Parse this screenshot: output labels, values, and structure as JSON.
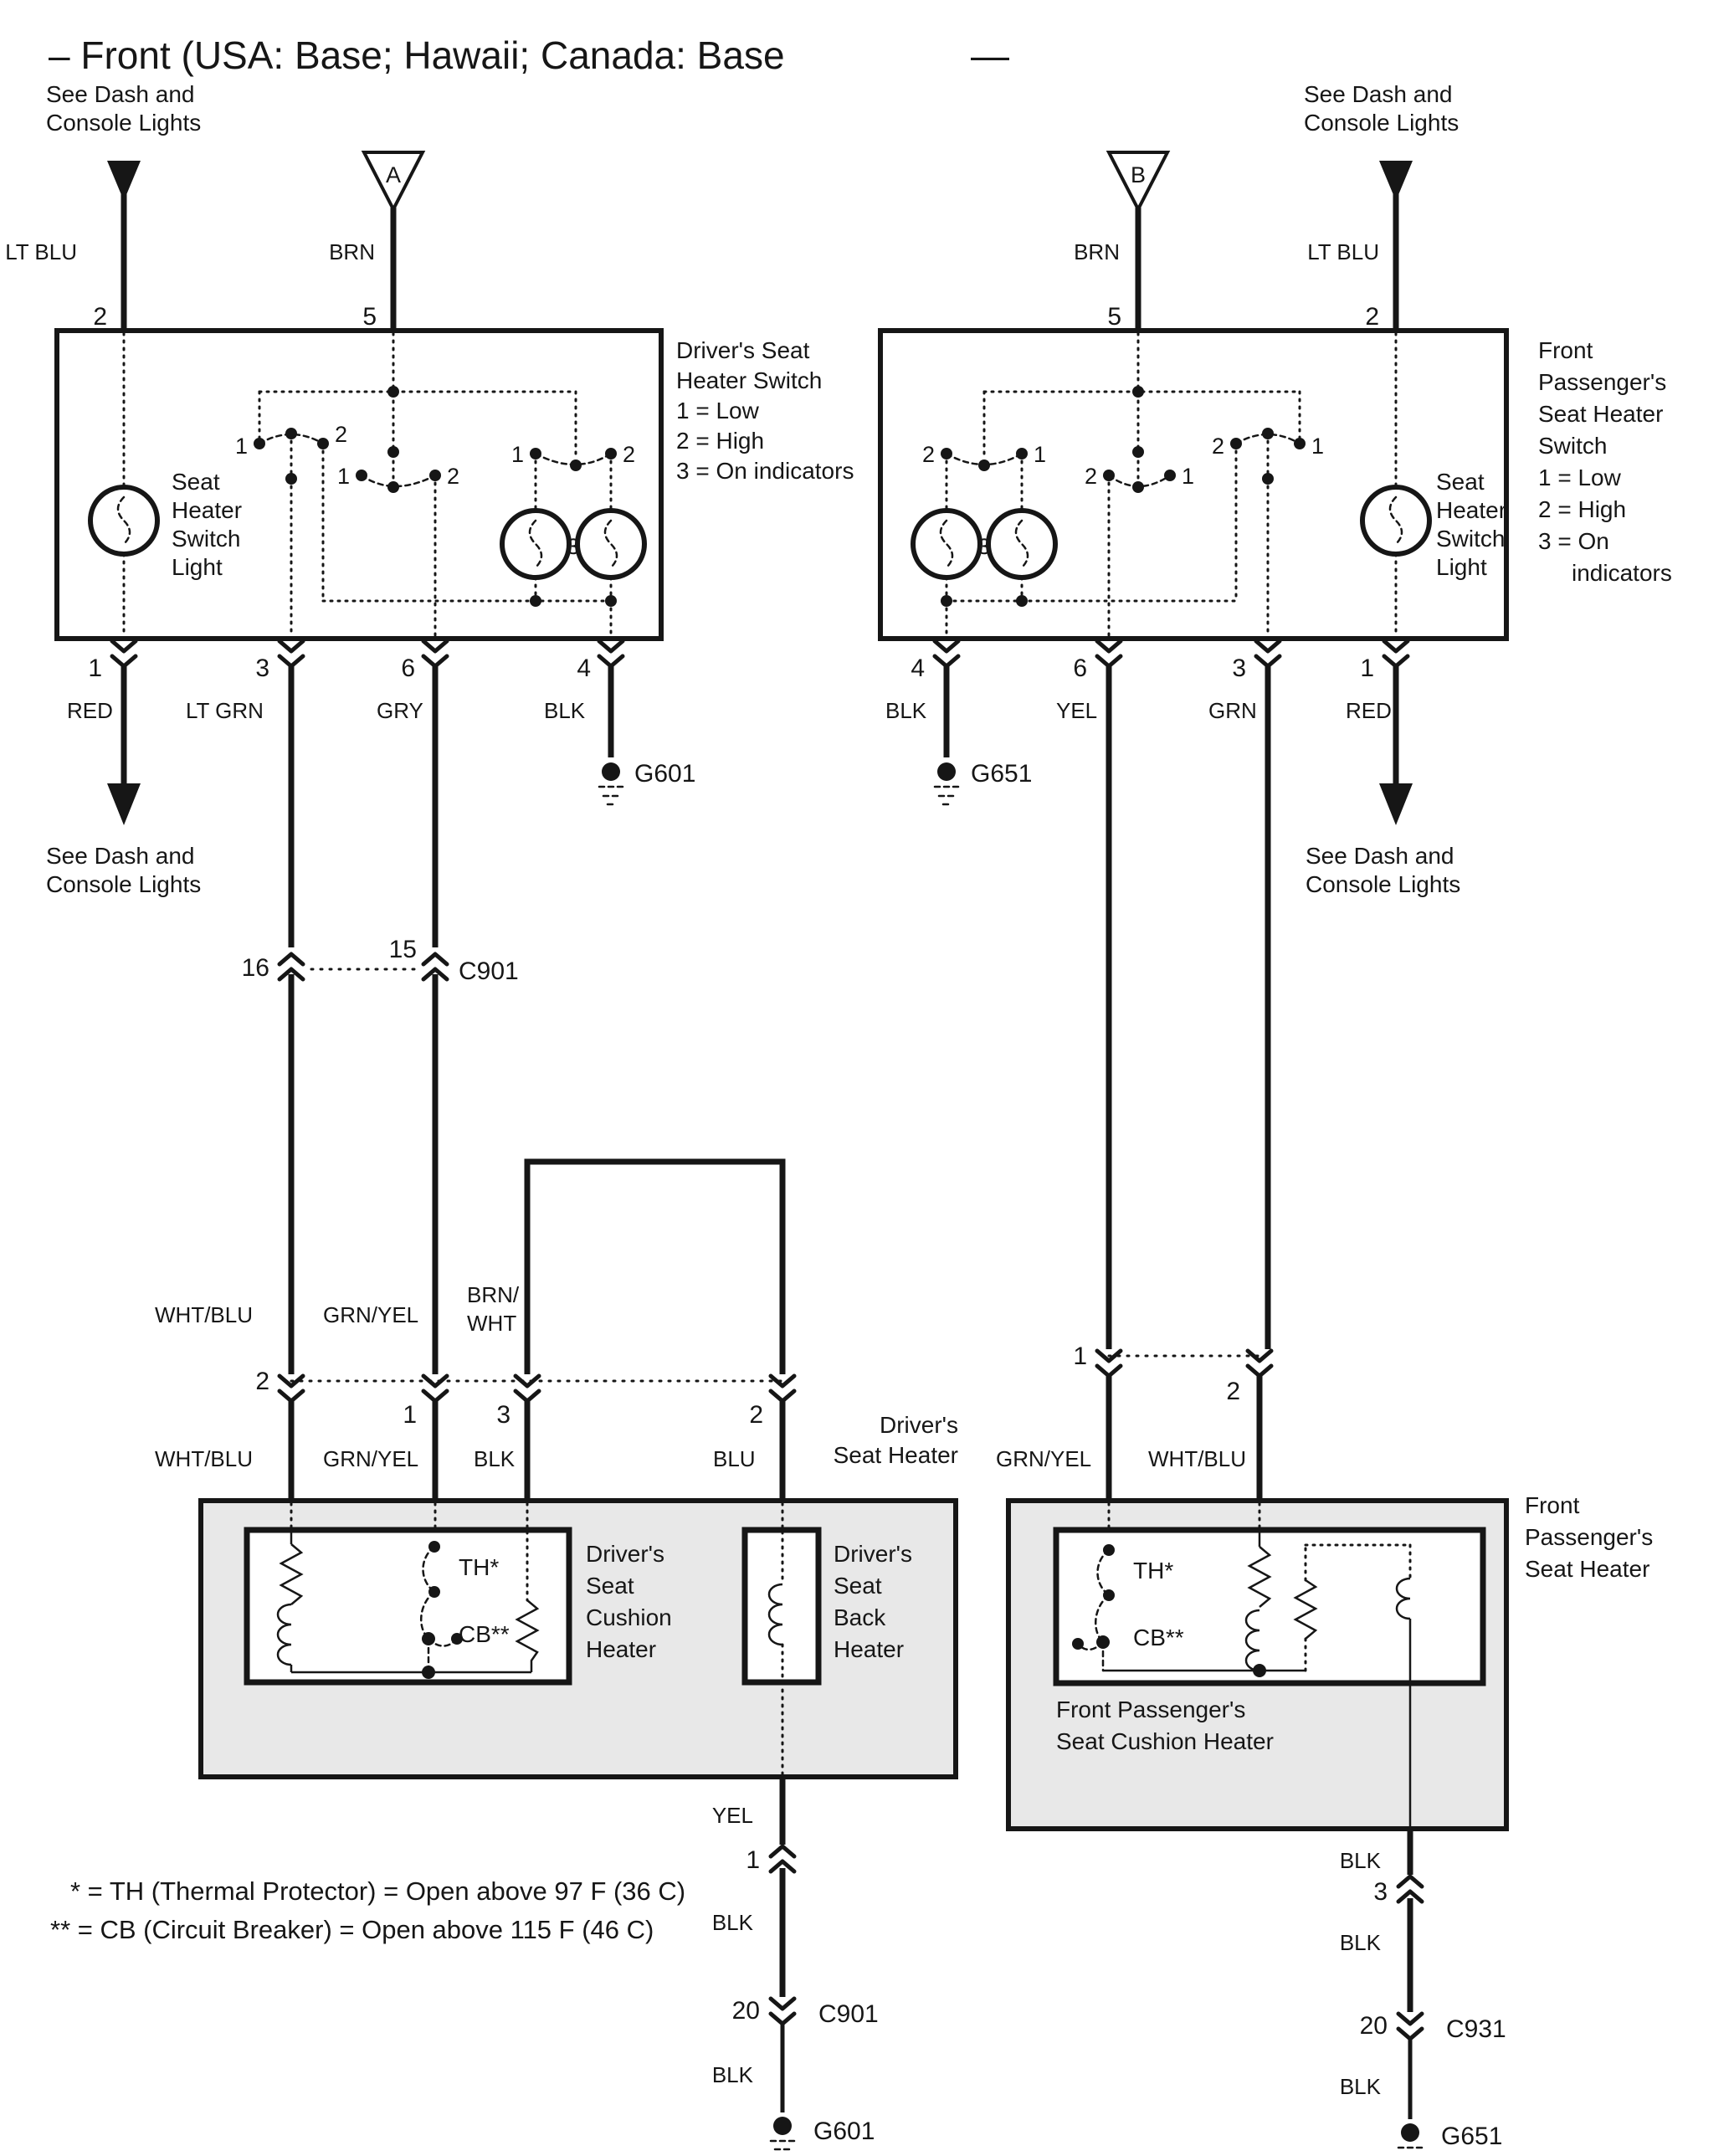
{
  "title": {
    "text": "– Front (USA: Base; Hawaii; Canada: Base",
    "dash": "—"
  },
  "notes": {
    "see_dash1": "See Dash and",
    "see_dash2": "Console Lights"
  },
  "wire_colors": {
    "lt_blu": "LT BLU",
    "brn": "BRN",
    "red": "RED",
    "lt_grn": "LT GRN",
    "gry": "GRY",
    "blk": "BLK",
    "yel": "YEL",
    "grn": "GRN",
    "wht_blu": "WHT/BLU",
    "grn_yel": "GRN/YEL",
    "brn_wht_a": "BRN/",
    "brn_wht_b": "WHT",
    "blu": "BLU"
  },
  "pins": {
    "n1": "1",
    "n2": "2",
    "n3": "3",
    "n4": "4",
    "n5": "5",
    "n6": "6",
    "n15": "15",
    "n16": "16",
    "n20": "20"
  },
  "connectors": {
    "a": "A",
    "b": "B",
    "c901": "C901",
    "c931": "C931"
  },
  "grounds": {
    "g601": "G601",
    "g651": "G651"
  },
  "driver_switch": {
    "label1": "Driver's Seat",
    "label2": "Heater Switch",
    "low": "1 = Low",
    "high": "2 = High",
    "on": "3 = On indicators",
    "light1": "Seat",
    "light2": "Heater",
    "light3": "Switch",
    "light4": "Light"
  },
  "passenger_switch": {
    "label1": "Front",
    "label2": "Passenger's",
    "label3": "Seat Heater",
    "label4": "Switch",
    "low": "1 = Low",
    "high": "2 = High",
    "on1": "3 = On",
    "on2": "indicators",
    "light1": "Seat",
    "light2": "Heater",
    "light3": "Switch",
    "light4": "Light"
  },
  "driver_heater": {
    "label1": "Driver's",
    "label2": "Seat Heater",
    "cushion1": "Driver's",
    "cushion2": "Seat",
    "cushion3": "Cushion",
    "cushion4": "Heater",
    "back1": "Driver's",
    "back2": "Seat",
    "back3": "Back",
    "back4": "Heater",
    "th": "TH*",
    "cb": "CB**"
  },
  "passenger_heater": {
    "label1": "Front",
    "label2": "Passenger's",
    "label3": "Seat Heater",
    "cushion1": "Front Passenger's",
    "cushion2": "Seat Cushion Heater",
    "th": "TH*",
    "cb": "CB**"
  },
  "footnotes": {
    "th": "* = TH (Thermal Protector) = Open above 97 F (36 C)",
    "cb": "** = CB (Circuit Breaker) = Open above 115 F (46 C)"
  }
}
